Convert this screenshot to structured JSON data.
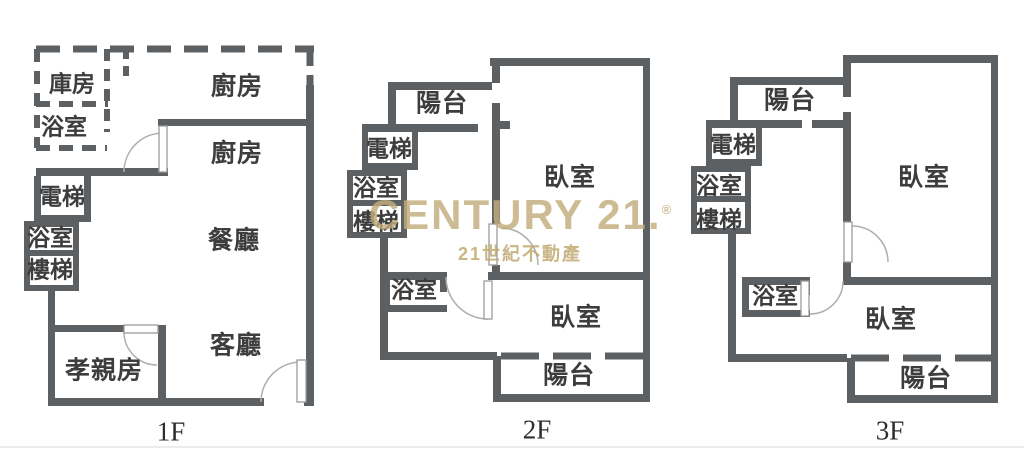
{
  "colors": {
    "wall": "#5d6063",
    "label": "#3d3d3d",
    "watermark": "#c3ad7c",
    "watermark_tagline": "#bfa66b",
    "background": "#ffffff"
  },
  "watermark": {
    "brand": "CENTURY 21.",
    "registered_mark": "®",
    "tagline": "21世紀不動產"
  },
  "floors": [
    {
      "id": "1F",
      "label": "1F",
      "rooms": [
        {
          "name": "storage-room",
          "label": "庫房"
        },
        {
          "name": "bathroom-upper",
          "label": "浴室"
        },
        {
          "name": "kitchen-upper",
          "label": "廚房"
        },
        {
          "name": "kitchen-lower",
          "label": "廚房"
        },
        {
          "name": "elevator",
          "label": "電梯"
        },
        {
          "name": "bathroom-left",
          "label": "浴室"
        },
        {
          "name": "stairs",
          "label": "樓梯"
        },
        {
          "name": "dining-room",
          "label": "餐廳"
        },
        {
          "name": "living-room",
          "label": "客廳"
        },
        {
          "name": "parents-room",
          "label": "孝親房"
        }
      ]
    },
    {
      "id": "2F",
      "label": "2F",
      "rooms": [
        {
          "name": "balcony-top",
          "label": "陽台"
        },
        {
          "name": "elevator",
          "label": "電梯"
        },
        {
          "name": "bathroom-left",
          "label": "浴室"
        },
        {
          "name": "stairs",
          "label": "樓梯"
        },
        {
          "name": "bedroom-main",
          "label": "臥室"
        },
        {
          "name": "bathroom-mid",
          "label": "浴室"
        },
        {
          "name": "bedroom-second",
          "label": "臥室"
        },
        {
          "name": "balcony-bottom",
          "label": "陽台"
        }
      ]
    },
    {
      "id": "3F",
      "label": "3F",
      "rooms": [
        {
          "name": "balcony-top",
          "label": "陽台"
        },
        {
          "name": "elevator",
          "label": "電梯"
        },
        {
          "name": "bathroom-left",
          "label": "浴室"
        },
        {
          "name": "stairs",
          "label": "樓梯"
        },
        {
          "name": "bedroom-main",
          "label": "臥室"
        },
        {
          "name": "bathroom-mid",
          "label": "浴室"
        },
        {
          "name": "bedroom-second",
          "label": "臥室"
        },
        {
          "name": "balcony-bottom",
          "label": "陽台"
        }
      ]
    }
  ]
}
